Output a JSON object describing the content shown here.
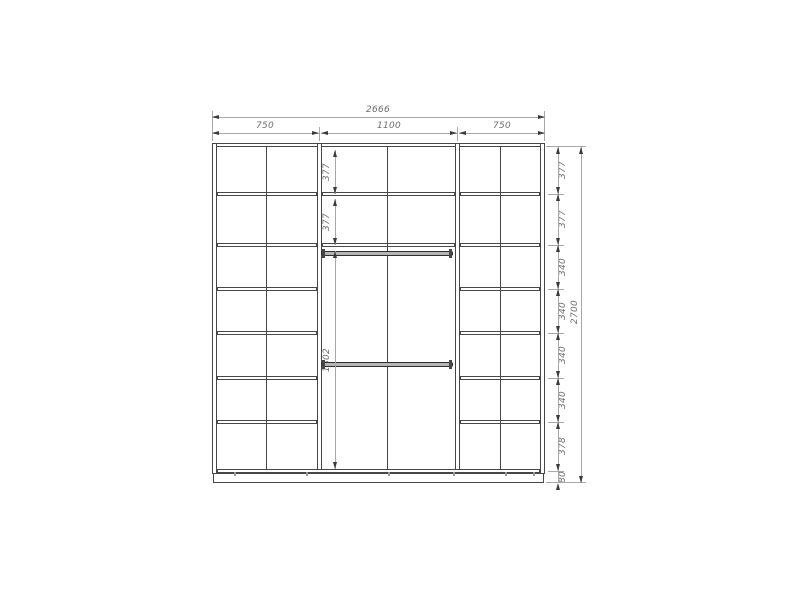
{
  "drawing": {
    "overall_width": "2666",
    "section_widths": [
      "750",
      "1100",
      "750"
    ],
    "overall_height": "2700",
    "right_row_heights": [
      "377",
      "377",
      "340",
      "340",
      "340",
      "340",
      "378",
      "80"
    ],
    "inner_dims": [
      "377",
      "377",
      "1802"
    ],
    "colors": {
      "drawing_line": "#474747",
      "dimension_line": "#a8a8a8",
      "label_text": "#6e6e6e",
      "background": "#ffffff"
    }
  }
}
